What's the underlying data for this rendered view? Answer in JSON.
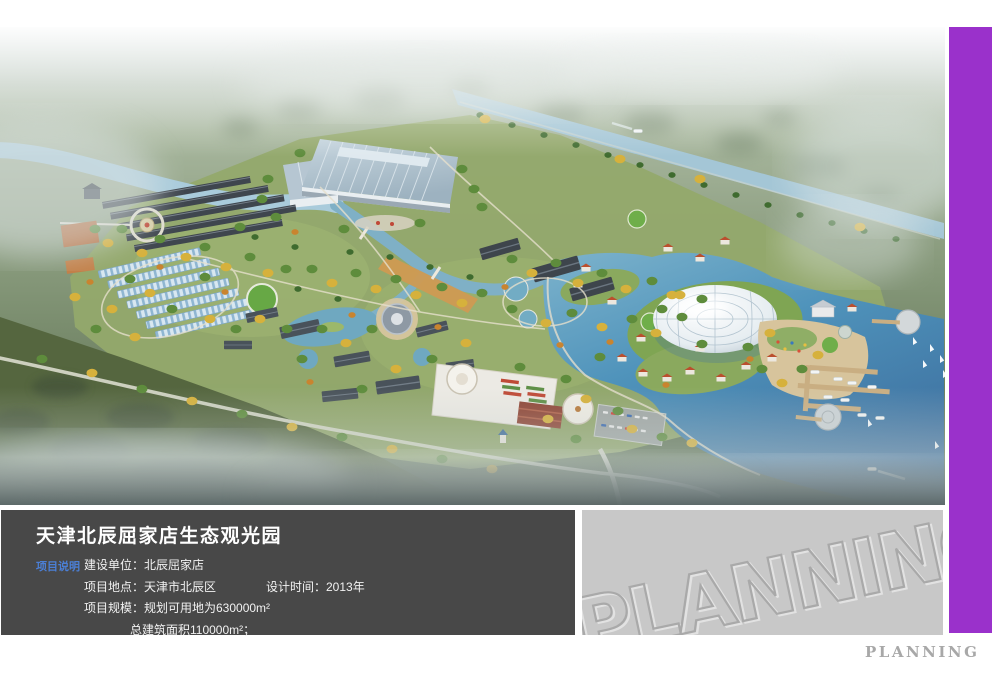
{
  "colors": {
    "accent-purple": "#9a31cb",
    "panel-dark": "#484848",
    "panel-gray": "#c8c8c8",
    "label-blue": "#4b7fd6",
    "brand-gray": "#a8a8a8"
  },
  "info_panel": {
    "title": "天津北辰屈家店生态观光园",
    "section_label": "项目说明",
    "rows": [
      {
        "left": "建设单位：北辰屈家店",
        "right": ""
      },
      {
        "left": "项目地点：天津市北辰区",
        "right": "设计时间：2013年"
      },
      {
        "left": "项目规模：规划可用地为630000m²",
        "right": ""
      },
      {
        "left": "总建筑面积110000m²；",
        "right": ""
      }
    ]
  },
  "watermark_panel": {
    "text": "PLANNING"
  },
  "footer": {
    "wordmark": "PLANNING"
  }
}
